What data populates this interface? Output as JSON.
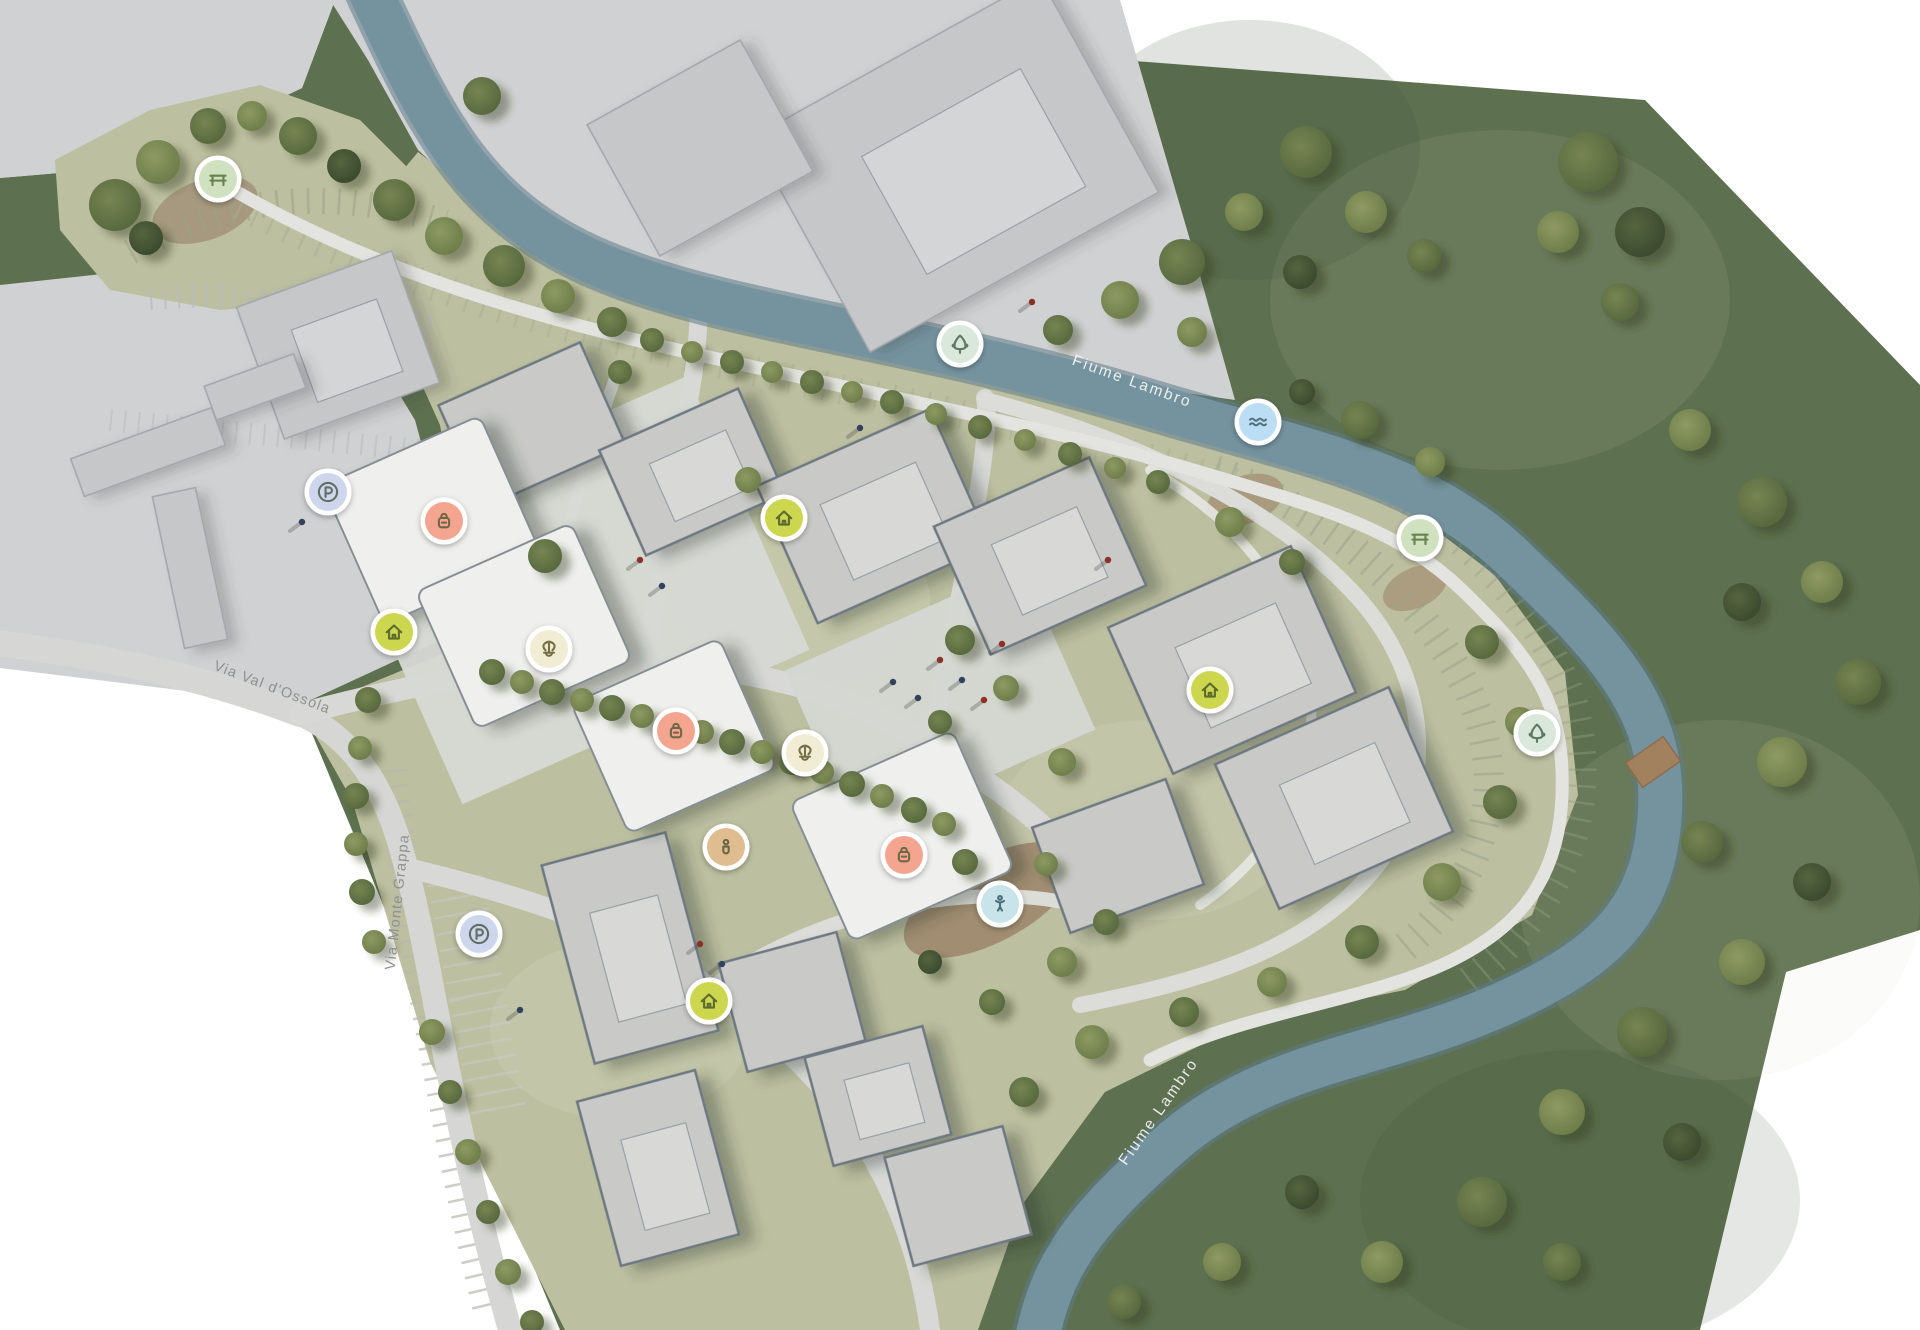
{
  "canvas": {
    "width": 1920,
    "height": 1330,
    "background": "#ffffff"
  },
  "palette": {
    "countryside": "#5d7050",
    "site_lawn": "#bcbfa0",
    "context_gray": "#d0d1d2",
    "river": "#6f8e9b",
    "road": "#d8d9d6",
    "footpath": "#e3e4e0",
    "building_site": "#c9cac7",
    "building_context": "#c6c7c9",
    "building_white": "#eff0ee",
    "dirt": "#9c8468"
  },
  "legend": {
    "bench": {
      "fill": "#cfe1bf",
      "glyph": "#69814f"
    },
    "tree": {
      "fill": "#d9e8da",
      "glyph": "#5f7a62"
    },
    "water": {
      "fill": "#bcdef4",
      "glyph": "#53707c"
    },
    "parking": {
      "fill": "#ced6ee",
      "glyph": "#5f6f62"
    },
    "shop": {
      "fill": "#f4a590",
      "glyph": "#6f6845"
    },
    "home": {
      "fill": "#ccd74f",
      "glyph": "#5d6b2e"
    },
    "fountain": {
      "fill": "#f1ecd4",
      "glyph": "#756f45"
    },
    "person": {
      "fill": "#dfbd90",
      "glyph": "#6b6544"
    },
    "playground": {
      "fill": "#c8e4ea",
      "glyph": "#4a7078"
    }
  },
  "markers": [
    {
      "icon": "bench",
      "x": 218,
      "y": 179
    },
    {
      "icon": "tree",
      "x": 960,
      "y": 344
    },
    {
      "icon": "water",
      "x": 1258,
      "y": 422
    },
    {
      "icon": "bench",
      "x": 1420,
      "y": 538
    },
    {
      "icon": "tree",
      "x": 1537,
      "y": 733
    },
    {
      "icon": "parking",
      "x": 328,
      "y": 492
    },
    {
      "icon": "shop",
      "x": 444,
      "y": 521
    },
    {
      "icon": "home",
      "x": 394,
      "y": 632
    },
    {
      "icon": "home",
      "x": 784,
      "y": 518
    },
    {
      "icon": "fountain",
      "x": 549,
      "y": 649
    },
    {
      "icon": "shop",
      "x": 676,
      "y": 731
    },
    {
      "icon": "fountain",
      "x": 805,
      "y": 753
    },
    {
      "icon": "person",
      "x": 726,
      "y": 847
    },
    {
      "icon": "shop",
      "x": 904,
      "y": 855
    },
    {
      "icon": "playground",
      "x": 1000,
      "y": 904
    },
    {
      "icon": "home",
      "x": 1210,
      "y": 690
    },
    {
      "icon": "parking",
      "x": 479,
      "y": 934
    },
    {
      "icon": "home",
      "x": 709,
      "y": 1001
    }
  ],
  "labels": [
    {
      "text": "Fiume Lambro",
      "x": 1132,
      "y": 382,
      "rot": 20,
      "style": "river"
    },
    {
      "text": "Fiume Lambro",
      "x": 1159,
      "y": 1112,
      "rot": -55,
      "style": "river"
    },
    {
      "text": "Via Val d'Ossola",
      "x": 272,
      "y": 688,
      "rot": 21,
      "style": "street"
    },
    {
      "text": "Via Monte Grappa",
      "x": 398,
      "y": 902,
      "rot": -84,
      "style": "street"
    }
  ],
  "buildings": [
    [
      955,
      165,
      330,
      245,
      -29,
      "ctx",
      1
    ],
    [
      700,
      148,
      175,
      150,
      -29,
      "ctx",
      0
    ],
    [
      338,
      345,
      165,
      140,
      -20,
      "ctx",
      1
    ],
    [
      148,
      452,
      150,
      40,
      -20,
      "ctx",
      0
    ],
    [
      255,
      387,
      95,
      36,
      -20,
      "ctx",
      0
    ],
    [
      190,
      568,
      44,
      155,
      -12,
      "ctx",
      0
    ],
    [
      532,
      425,
      155,
      112,
      -24,
      "site",
      0
    ],
    [
      692,
      472,
      152,
      115,
      -24,
      "site",
      1
    ],
    [
      874,
      516,
      190,
      150,
      -24,
      "site",
      1
    ],
    [
      1040,
      556,
      170,
      140,
      -24,
      "site",
      1
    ],
    [
      1232,
      660,
      200,
      160,
      -24,
      "site",
      1
    ],
    [
      1334,
      798,
      190,
      158,
      -24,
      "site",
      1
    ],
    [
      630,
      948,
      128,
      205,
      -15,
      "site",
      1
    ],
    [
      658,
      1168,
      122,
      170,
      -15,
      "site",
      1
    ],
    [
      792,
      1002,
      122,
      112,
      -15,
      "site",
      0
    ],
    [
      878,
      1096,
      122,
      112,
      -15,
      "site",
      1
    ],
    [
      958,
      1196,
      122,
      112,
      -15,
      "site",
      0
    ],
    [
      1118,
      856,
      142,
      112,
      -20,
      "site",
      0
    ],
    [
      432,
      520,
      172,
      152,
      -24,
      "white",
      0
    ],
    [
      524,
      626,
      170,
      150,
      -24,
      "white",
      0
    ],
    [
      674,
      736,
      162,
      142,
      -24,
      "white",
      0
    ],
    [
      902,
      836,
      178,
      152,
      -24,
      "white",
      0
    ]
  ],
  "trees": [
    [
      115,
      205,
      26,
      1
    ],
    [
      158,
      162,
      22,
      2
    ],
    [
      208,
      126,
      18,
      1
    ],
    [
      146,
      238,
      17,
      0
    ],
    [
      252,
      116,
      15,
      2
    ],
    [
      298,
      136,
      19,
      1
    ],
    [
      344,
      166,
      17,
      0
    ],
    [
      394,
      200,
      21,
      1
    ],
    [
      444,
      236,
      19,
      2
    ],
    [
      504,
      266,
      21,
      1
    ],
    [
      558,
      296,
      17,
      2
    ],
    [
      612,
      322,
      15,
      1
    ],
    [
      652,
      340,
      12,
      1
    ],
    [
      692,
      352,
      11,
      2
    ],
    [
      732,
      362,
      12,
      1
    ],
    [
      772,
      372,
      11,
      2
    ],
    [
      812,
      382,
      12,
      1
    ],
    [
      852,
      392,
      11,
      2
    ],
    [
      892,
      402,
      12,
      1
    ],
    [
      936,
      414,
      11,
      2
    ],
    [
      980,
      427,
      12,
      1
    ],
    [
      1025,
      440,
      11,
      2
    ],
    [
      1070,
      454,
      12,
      1
    ],
    [
      1115,
      468,
      11,
      2
    ],
    [
      1158,
      482,
      12,
      1
    ],
    [
      482,
      96,
      19,
      1
    ],
    [
      1058,
      330,
      15,
      1
    ],
    [
      1120,
      300,
      19,
      2
    ],
    [
      1182,
      262,
      23,
      1
    ],
    [
      1244,
      212,
      19,
      2
    ],
    [
      1306,
      152,
      26,
      1
    ],
    [
      1366,
      212,
      21,
      2
    ],
    [
      1424,
      256,
      17,
      1
    ],
    [
      1300,
      272,
      17,
      0
    ],
    [
      1192,
      332,
      15,
      2
    ],
    [
      1588,
      162,
      30,
      1
    ],
    [
      1640,
      232,
      25,
      0
    ],
    [
      1558,
      232,
      21,
      2
    ],
    [
      1620,
      302,
      19,
      1
    ],
    [
      1690,
      430,
      21,
      2
    ],
    [
      1762,
      502,
      25,
      1
    ],
    [
      1822,
      582,
      21,
      2
    ],
    [
      1742,
      602,
      19,
      0
    ],
    [
      1858,
      682,
      23,
      1
    ],
    [
      1782,
      762,
      25,
      2
    ],
    [
      1702,
      842,
      21,
      1
    ],
    [
      1812,
      882,
      19,
      0
    ],
    [
      1742,
      962,
      23,
      2
    ],
    [
      1642,
      1032,
      25,
      1
    ],
    [
      1562,
      1112,
      23,
      2
    ],
    [
      1682,
      1142,
      19,
      0
    ],
    [
      1482,
      1202,
      25,
      1
    ],
    [
      1382,
      1262,
      21,
      2
    ],
    [
      1562,
      1262,
      19,
      1
    ],
    [
      1302,
      1192,
      17,
      0
    ],
    [
      1222,
      1262,
      19,
      2
    ],
    [
      1124,
      1302,
      17,
      1
    ],
    [
      1360,
      420,
      19,
      1
    ],
    [
      1430,
      462,
      15,
      2
    ],
    [
      1302,
      392,
      13,
      0
    ],
    [
      1482,
      642,
      17,
      1
    ],
    [
      1520,
      722,
      15,
      2
    ],
    [
      1500,
      802,
      17,
      1
    ],
    [
      1442,
      882,
      19,
      2
    ],
    [
      1362,
      942,
      17,
      1
    ],
    [
      1272,
      982,
      15,
      2
    ],
    [
      1184,
      1012,
      15,
      1
    ],
    [
      1092,
      1042,
      17,
      2
    ],
    [
      1024,
      1092,
      15,
      1
    ],
    [
      492,
      672,
      13,
      1
    ],
    [
      522,
      682,
      12,
      2
    ],
    [
      552,
      692,
      13,
      1
    ],
    [
      582,
      700,
      12,
      2
    ],
    [
      612,
      708,
      13,
      1
    ],
    [
      642,
      716,
      12,
      2
    ],
    [
      672,
      724,
      13,
      1
    ],
    [
      702,
      732,
      12,
      2
    ],
    [
      732,
      742,
      13,
      1
    ],
    [
      762,
      752,
      12,
      2
    ],
    [
      792,
      762,
      13,
      1
    ],
    [
      822,
      772,
      12,
      2
    ],
    [
      852,
      784,
      13,
      1
    ],
    [
      882,
      796,
      12,
      2
    ],
    [
      914,
      810,
      13,
      1
    ],
    [
      944,
      824,
      12,
      2
    ],
    [
      368,
      700,
      13,
      1
    ],
    [
      360,
      748,
      12,
      2
    ],
    [
      356,
      796,
      13,
      1
    ],
    [
      356,
      844,
      12,
      2
    ],
    [
      362,
      892,
      13,
      1
    ],
    [
      374,
      942,
      12,
      2
    ],
    [
      432,
      1032,
      13,
      2
    ],
    [
      450,
      1092,
      12,
      1
    ],
    [
      468,
      1152,
      13,
      2
    ],
    [
      488,
      1212,
      12,
      1
    ],
    [
      508,
      1272,
      13,
      2
    ],
    [
      532,
      1322,
      12,
      1
    ],
    [
      545,
      556,
      17,
      1
    ],
    [
      960,
      640,
      15,
      1
    ],
    [
      1006,
      688,
      13,
      2
    ],
    [
      940,
      722,
      12,
      1
    ],
    [
      1062,
      762,
      14,
      2
    ],
    [
      1230,
      522,
      15,
      2
    ],
    [
      1292,
      562,
      13,
      1
    ],
    [
      965,
      862,
      13,
      1
    ],
    [
      1046,
      864,
      12,
      2
    ],
    [
      1106,
      922,
      13,
      1
    ],
    [
      1062,
      962,
      15,
      2
    ],
    [
      992,
      1002,
      13,
      1
    ],
    [
      930,
      962,
      12,
      0
    ],
    [
      748,
      480,
      13,
      2
    ],
    [
      620,
      372,
      12,
      1
    ]
  ],
  "people": [
    [
      940,
      660,
      0
    ],
    [
      962,
      680,
      1
    ],
    [
      984,
      700,
      0
    ],
    [
      918,
      698,
      1
    ],
    [
      1002,
      644,
      0
    ],
    [
      893,
      682,
      1
    ],
    [
      640,
      560,
      0
    ],
    [
      662,
      586,
      1
    ],
    [
      700,
      944,
      0
    ],
    [
      722,
      964,
      1
    ],
    [
      320,
      478,
      0
    ],
    [
      302,
      522,
      1
    ],
    [
      1032,
      302,
      0
    ],
    [
      860,
      428,
      1
    ],
    [
      1108,
      560,
      0
    ],
    [
      520,
      1010,
      1
    ]
  ]
}
